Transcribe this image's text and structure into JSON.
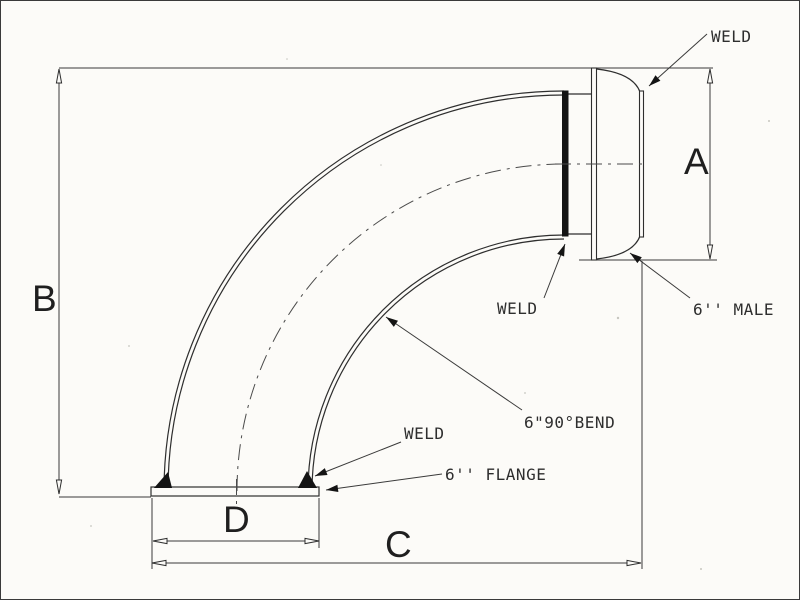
{
  "labels": {
    "weld_top": "WELD",
    "weld_mid": "WELD",
    "weld_bottom": "WELD",
    "bend_callout": "6\"90°BEND",
    "flange_callout": "6'' FLANGE",
    "male_callout": "6'' MALE",
    "dim_a": "A",
    "dim_b": "B",
    "dim_c": "C",
    "dim_d": "D"
  },
  "colors": {
    "ink": "#2e2e2e",
    "paper": "#fcfbf8",
    "weld_fill": "#141414"
  }
}
